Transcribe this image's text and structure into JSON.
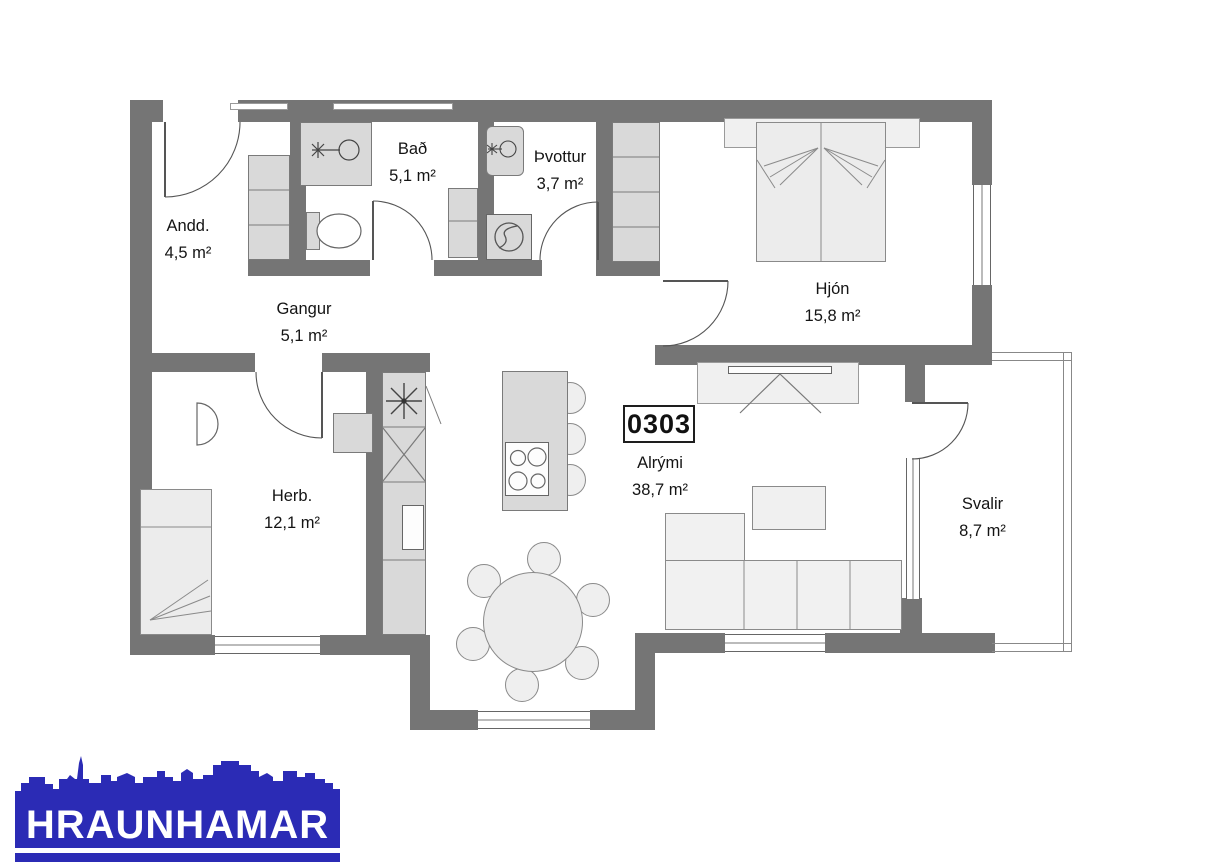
{
  "unit": {
    "number": "0303"
  },
  "rooms": [
    {
      "name": "Andd.",
      "area": "4,5 m²"
    },
    {
      "name": "Bað",
      "area": "5,1 m²"
    },
    {
      "name": "Þvottur",
      "area": "3,7 m²"
    },
    {
      "name": "Hjón",
      "area": "15,8 m²"
    },
    {
      "name": "Gangur",
      "area": "5,1 m²"
    },
    {
      "name": "Herb.",
      "area": "12,1 m²"
    },
    {
      "name": "Alrými",
      "area": "38,7 m²"
    },
    {
      "name": "Svalir",
      "area": "8,7 m²"
    }
  ],
  "logo": {
    "name": "HRAUNHAMAR",
    "color": "#2b2bb5"
  },
  "colors": {
    "wall": "#757575",
    "cabinet": "#d9d9d9",
    "furniture": "#efefef",
    "text": "#141414"
  }
}
